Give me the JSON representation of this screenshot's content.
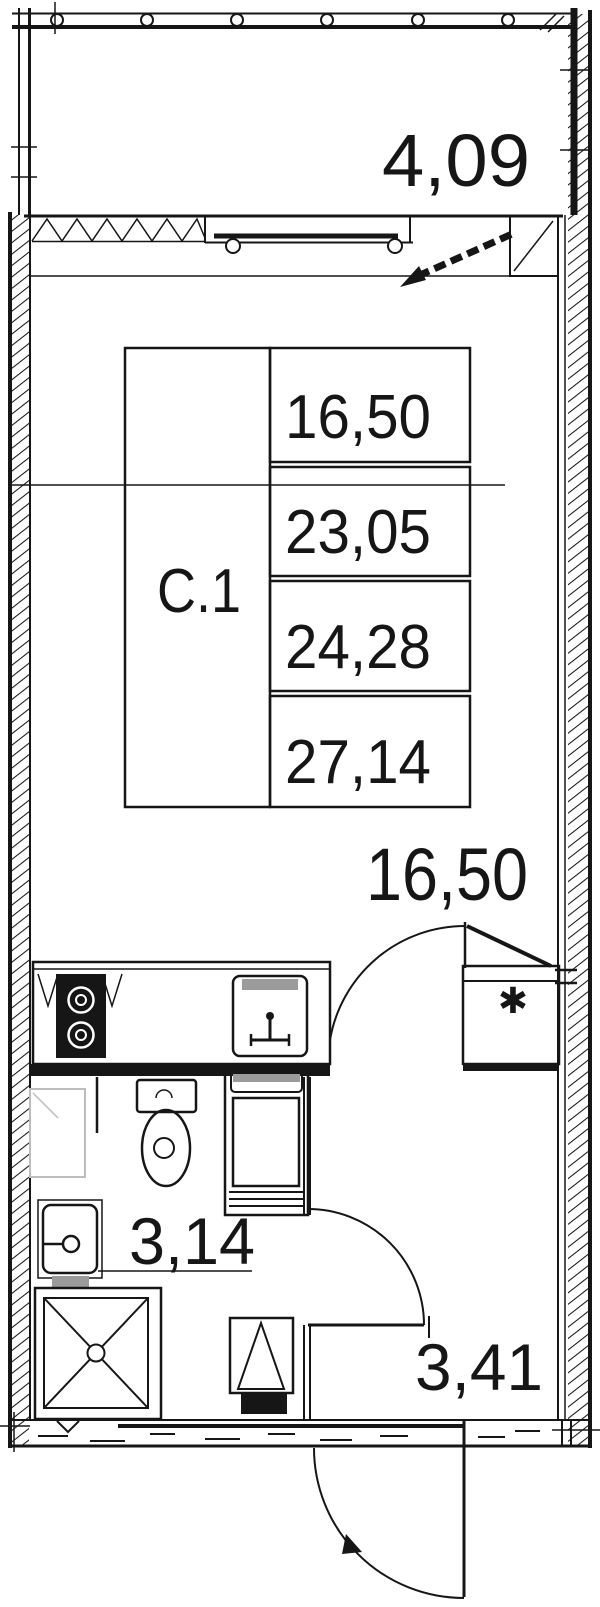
{
  "plan": {
    "unit_type_label": "С.1",
    "areas_table": {
      "values": [
        "16,50",
        "23,05",
        "24,28",
        "27,14"
      ]
    },
    "room_labels": {
      "balcony": "4,09",
      "living_room": "16,50",
      "bathroom": "3,14",
      "hallway": "3,41"
    },
    "symbols": {
      "closet_marker": "✱"
    },
    "colors": {
      "line": "#161616",
      "fixture_gray": "#9b9b9b",
      "ghost_gray": "#bdbdbd",
      "background": "#ffffff"
    }
  }
}
